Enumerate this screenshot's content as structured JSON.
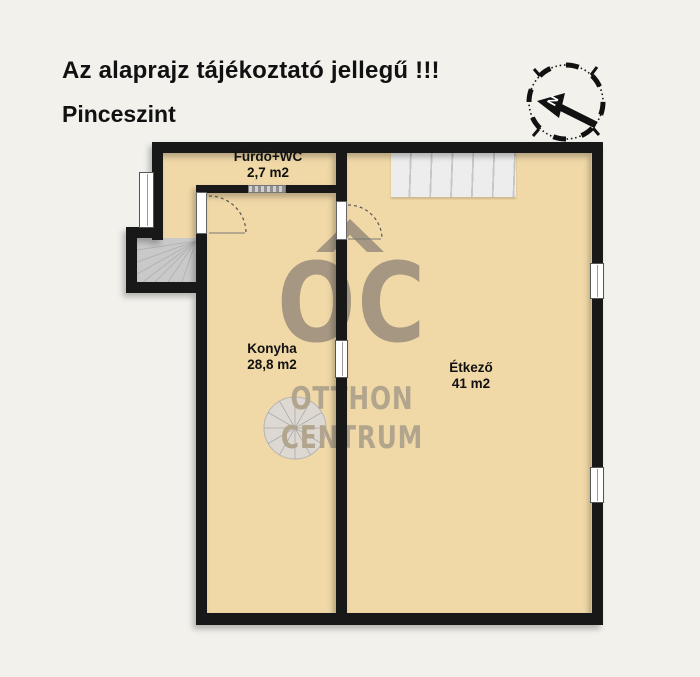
{
  "header": {
    "disclaimer": "Az alaprajz tájékoztató jellegű !!!",
    "floor_level": "Pinceszint"
  },
  "rooms": [
    {
      "name": "Fürdő+WC",
      "area": "2,7 m2"
    },
    {
      "name": "Konyha",
      "area": "28,8 m2"
    },
    {
      "name": "Étkező",
      "area": "41 m2"
    }
  ],
  "watermark": {
    "logo": "OC",
    "line1": "OTTHON",
    "line2": "CENTRUM"
  },
  "compass": {
    "north_label": "N"
  },
  "colors": {
    "background": "#f2f1ec",
    "floor": "#f0d8a7",
    "wall": "#181818",
    "watermark": "#a59781",
    "watermark-light": "#b2a58d",
    "stairs": "#ededed",
    "stairs-line": "#c6c6c6",
    "winder": "#c9c9c9",
    "text": "#111111"
  }
}
